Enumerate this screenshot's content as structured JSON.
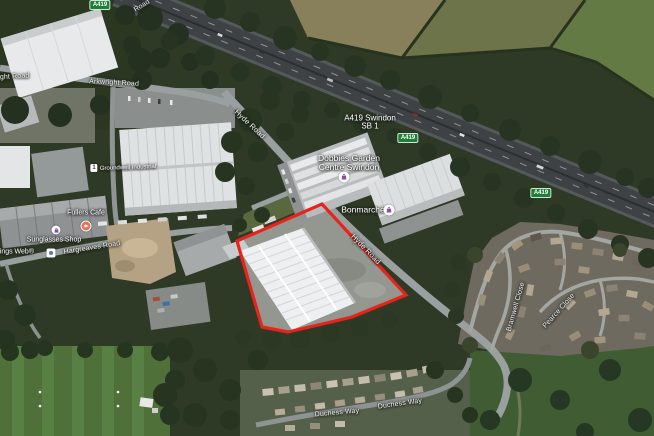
{
  "map": {
    "view": "satellite",
    "outline_color": "#e8231c",
    "badges": [
      {
        "label": "A419"
      },
      {
        "label": "A419"
      },
      {
        "label": "A419"
      }
    ],
    "motorway_label": {
      "line1": "A419 Swindon",
      "line2": "SB 1"
    },
    "roads": [
      {
        "text": "wright Road"
      },
      {
        "text": "Arkwright Road"
      },
      {
        "text": "Road"
      },
      {
        "text": "Hyde Road"
      },
      {
        "text": "Hyde Road"
      },
      {
        "text": "Hargreaves Road"
      },
      {
        "text": "Bramwell Close"
      },
      {
        "text": "Pearce Close"
      },
      {
        "text": "Duchess Way"
      },
      {
        "text": "Duchess Way"
      }
    ],
    "pois": [
      {
        "line1": "Dobbies Garden",
        "line2": "Centre Swindon"
      },
      {
        "text": "Bonmarché"
      },
      {
        "text": "Fullers Cafe"
      },
      {
        "text": "Sunglasses Shop"
      },
      {
        "text": "All Things Web®"
      },
      {
        "text": "Groundwell Industrial",
        "unit": "1"
      }
    ]
  }
}
